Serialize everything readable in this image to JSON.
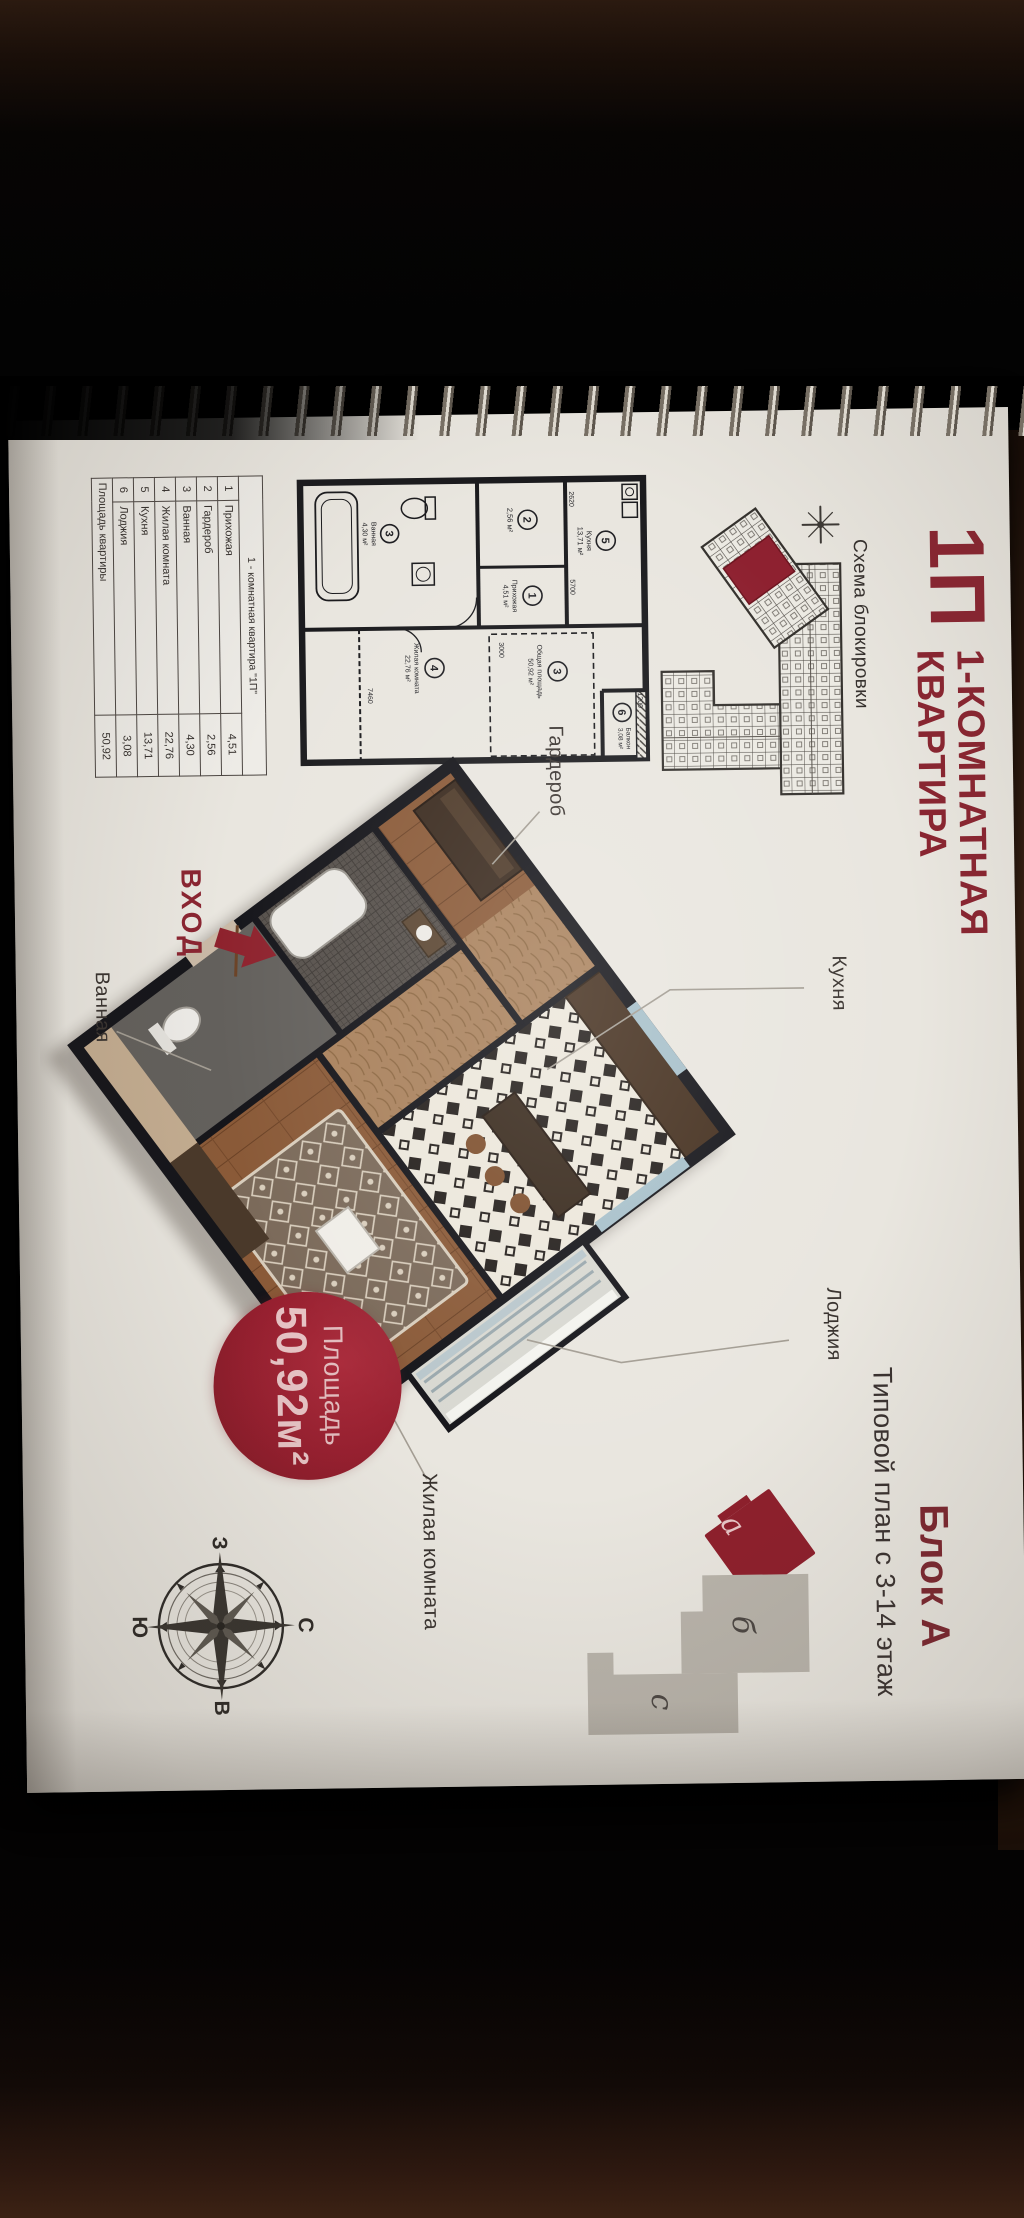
{
  "page": {
    "code": "1П",
    "title_line1": "1-КОМНАТНАЯ",
    "title_line2": "КВАРТИРА",
    "blocking_scheme_label": "Схема блокировки",
    "block_title": "Блок А",
    "floor_range_note": "Типовой план с 3-14 этаж",
    "entrance_label": "ВХОД"
  },
  "area_badge": {
    "label": "Площадь",
    "value": "50,92м²"
  },
  "plan_labels": {
    "wardrobe": "Гардероб",
    "bathroom": "Ванная",
    "kitchen": "Кухня",
    "loggia": "Лоджия",
    "living_room": "Жилая комната"
  },
  "schematic": {
    "rooms": [
      {
        "num": "5",
        "name": "Кухня",
        "area": "13,71 м²"
      },
      {
        "num": "6",
        "name": "Балкон",
        "area": "3,08 м²"
      },
      {
        "num": "3",
        "name": "Общая площадь",
        "area": "50,92 м²"
      },
      {
        "num": "2",
        "name": "",
        "area": "2,56 м²"
      },
      {
        "num": "1",
        "name": "Прихожая",
        "area": "4,51 м²"
      },
      {
        "num": "4",
        "name": "Жилая комната",
        "area": "22,76 м²"
      },
      {
        "num": "3",
        "name": "Ванная",
        "area": "4,30 м²"
      }
    ],
    "dims": {
      "kitchen_w": "2620",
      "kitchen_l": "5700",
      "balcony": "1200",
      "living_w": "3000",
      "living_l": "7460"
    }
  },
  "table": {
    "header": "1 - комнатная квартира \"1П\"",
    "rows": [
      {
        "num": "1",
        "name": "Прихожая",
        "area": "4,51"
      },
      {
        "num": "2",
        "name": "Гардероб",
        "area": "2,56"
      },
      {
        "num": "3",
        "name": "Ванная",
        "area": "4,30"
      },
      {
        "num": "4",
        "name": "Жилая комната",
        "area": "22,76"
      },
      {
        "num": "5",
        "name": "Кухня",
        "area": "13,71"
      },
      {
        "num": "6",
        "name": "Лоджия",
        "area": "3,08"
      }
    ],
    "total_label": "Площадь квартиры",
    "total_value": "50,92"
  },
  "compass": {
    "north": "С",
    "east": "В",
    "south": "Ю",
    "west": "З"
  },
  "block_scheme": {
    "block_a": "а",
    "block_b": "б",
    "block_c": "с"
  },
  "colors": {
    "accent_red": "#8a2531",
    "badge_red": "#9a2130",
    "wall_dark": "#17171c",
    "page_bg": "#e9e6df"
  }
}
